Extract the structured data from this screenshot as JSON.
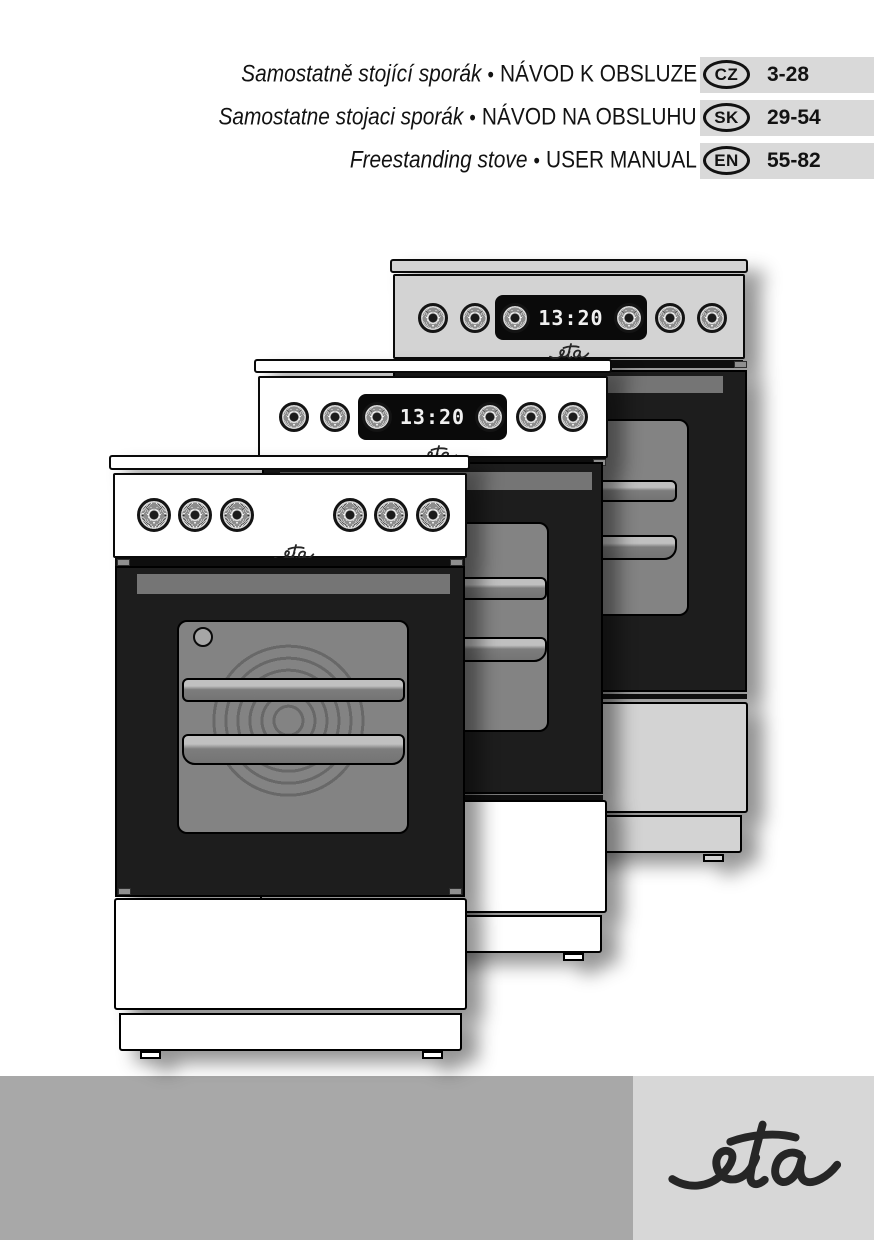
{
  "page": {
    "type": "user-manual-cover"
  },
  "header": {
    "separator": "•",
    "lines": [
      {
        "subtitle": "Samostatně stojící sporák",
        "title": "NÁVOD K OBSLUZE",
        "lang_badge": "CZ",
        "pages": "3-28"
      },
      {
        "subtitle": "Samostatne stojaci sporák",
        "title": "NÁVOD NA OBSLUHU",
        "lang_badge": "SK",
        "pages": "29-54"
      },
      {
        "subtitle": "Freestanding stove",
        "title": "USER MANUAL",
        "lang_badge": "EN",
        "pages": "55-82"
      }
    ]
  },
  "illustration": {
    "description": "three overlapping freestanding stoves",
    "stoves": [
      {
        "position": "back",
        "clock": "13:20",
        "brand": "eta",
        "knob_count": 6,
        "finish": "#d3d3d3"
      },
      {
        "position": "middle",
        "clock": "13:20",
        "brand": "eta",
        "knob_count": 6,
        "finish": "#ffffff"
      },
      {
        "position": "front",
        "brand": "eta",
        "knob_count": 6,
        "finish": "#ffffff"
      }
    ]
  },
  "footer": {
    "brand": "eta",
    "band_color": "#a8a8a8",
    "logo_box_color": "#d7d7d7"
  },
  "colors": {
    "header_band": "#d9d9d9",
    "door": "#1d1d1d",
    "window": "#838383"
  }
}
